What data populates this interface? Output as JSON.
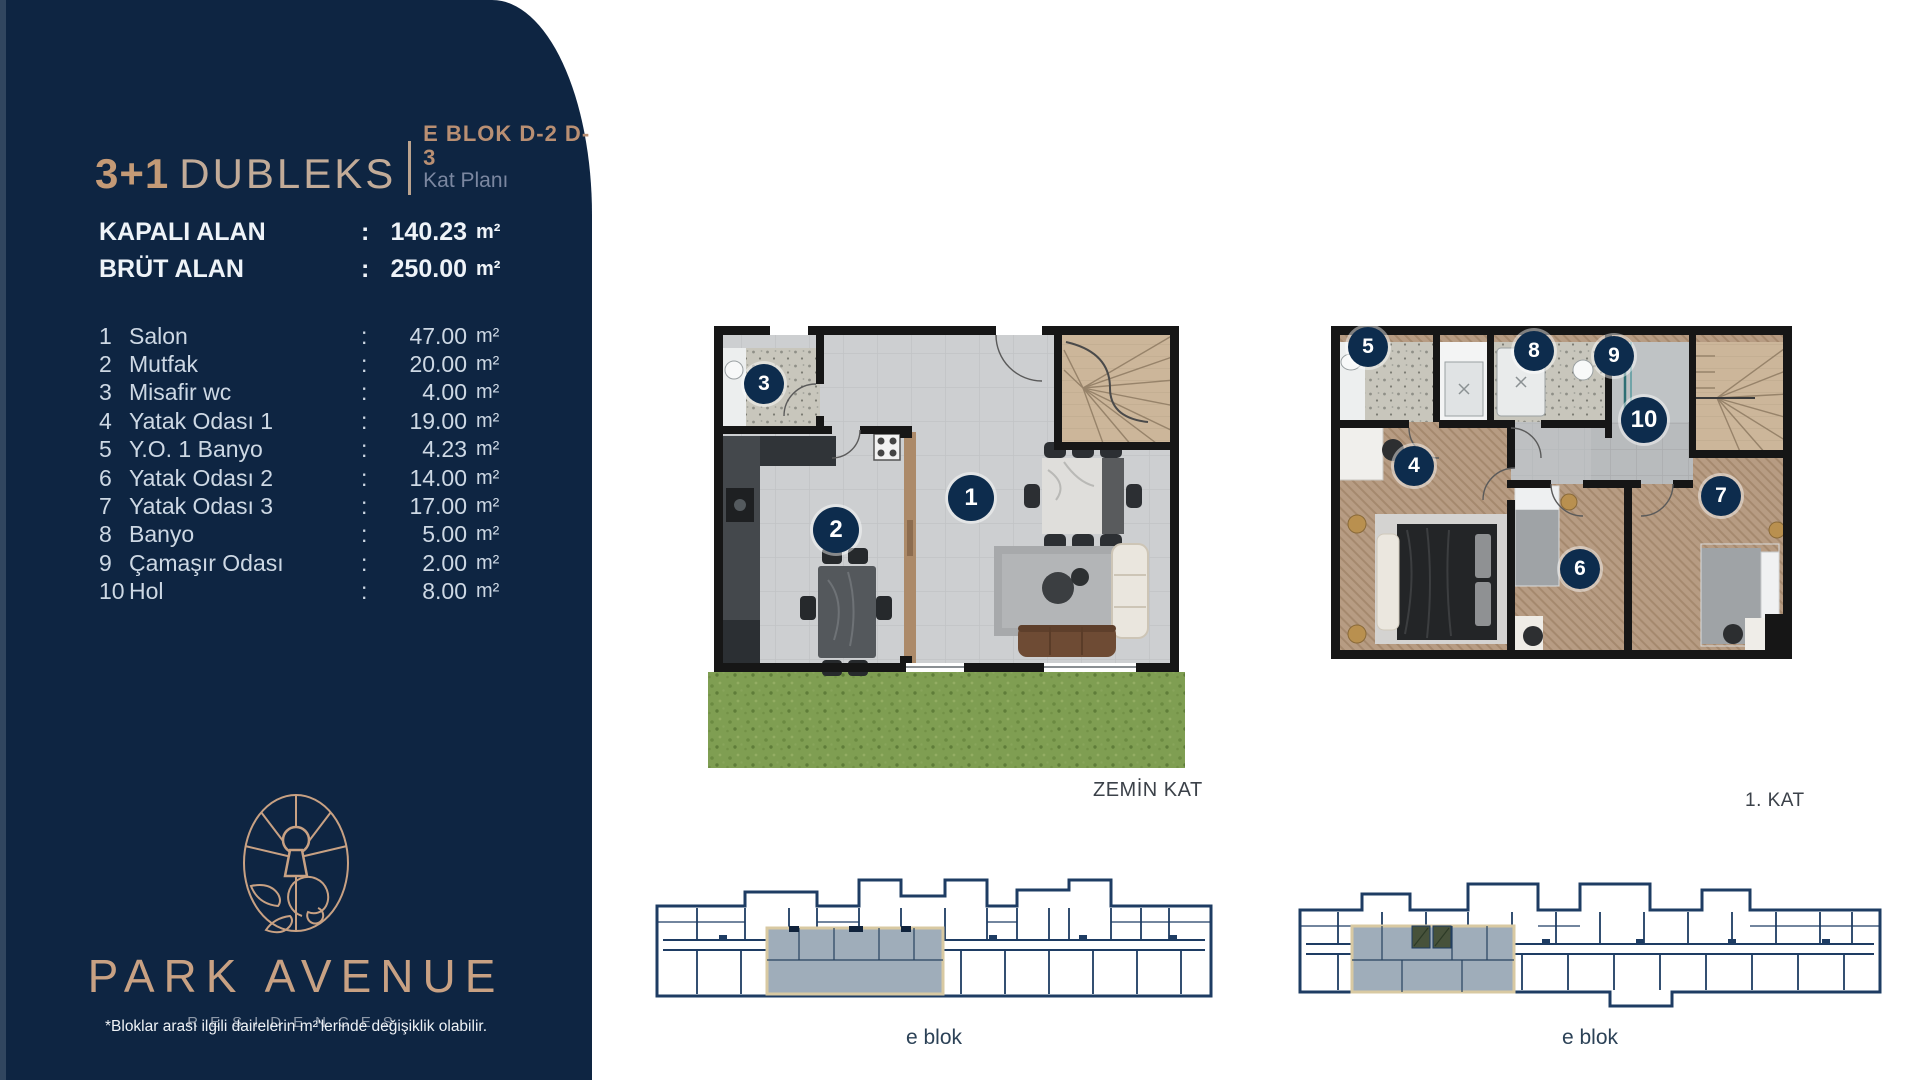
{
  "sidebar": {
    "title": {
      "type": "3+1",
      "name": "DUBLEKS",
      "block": "E BLOK D-2 D-3",
      "plan": "Kat Planı"
    },
    "areas": [
      {
        "label": "KAPALI ALAN",
        "value": "140.23",
        "unit": "m²"
      },
      {
        "label": "BRÜT ALAN",
        "value": "250.00",
        "unit": "m²"
      }
    ],
    "rooms": [
      {
        "no": "1",
        "name": "Salon",
        "value": "47.00",
        "unit": "m²"
      },
      {
        "no": "2",
        "name": "Mutfak",
        "value": "20.00",
        "unit": "m²"
      },
      {
        "no": "3",
        "name": "Misafir wc",
        "value": "4.00",
        "unit": "m²"
      },
      {
        "no": "4",
        "name": "Yatak Odası 1",
        "value": "19.00",
        "unit": "m²"
      },
      {
        "no": "5",
        "name": "Y.O. 1 Banyo",
        "value": "4.23",
        "unit": "m²"
      },
      {
        "no": "6",
        "name": "Yatak Odası 2",
        "value": "14.00",
        "unit": "m²"
      },
      {
        "no": "7",
        "name": "Yatak Odası 3",
        "value": "17.00",
        "unit": "m²"
      },
      {
        "no": "8",
        "name": "Banyo",
        "value": "5.00",
        "unit": "m²"
      },
      {
        "no": "9",
        "name": "Çamaşır Odası",
        "value": "2.00",
        "unit": "m²"
      },
      {
        "no": "10",
        "name": "Hol",
        "value": "8.00",
        "unit": "m²"
      }
    ],
    "logo": {
      "brand": "PARK AVENUE",
      "sub": "RESIDENCES"
    },
    "footnote": "*Bloklar arası ilgili dairelerin m²'lerinde değişiklik olabilir."
  },
  "plans": {
    "ground": {
      "label": "ZEMİN KAT",
      "badges": [
        "1",
        "2",
        "3"
      ]
    },
    "first": {
      "label": "1. KAT",
      "badges": [
        "4",
        "5",
        "6",
        "7",
        "8",
        "9",
        "10"
      ]
    }
  },
  "blocks": [
    {
      "label": "e blok"
    },
    {
      "label": "e blok"
    }
  ],
  "colors": {
    "navy": "#0e2542",
    "tan": "#c8a183",
    "badge": "#0d2c4d",
    "highlight": "#9fadba",
    "grass": "#7f9e52"
  }
}
